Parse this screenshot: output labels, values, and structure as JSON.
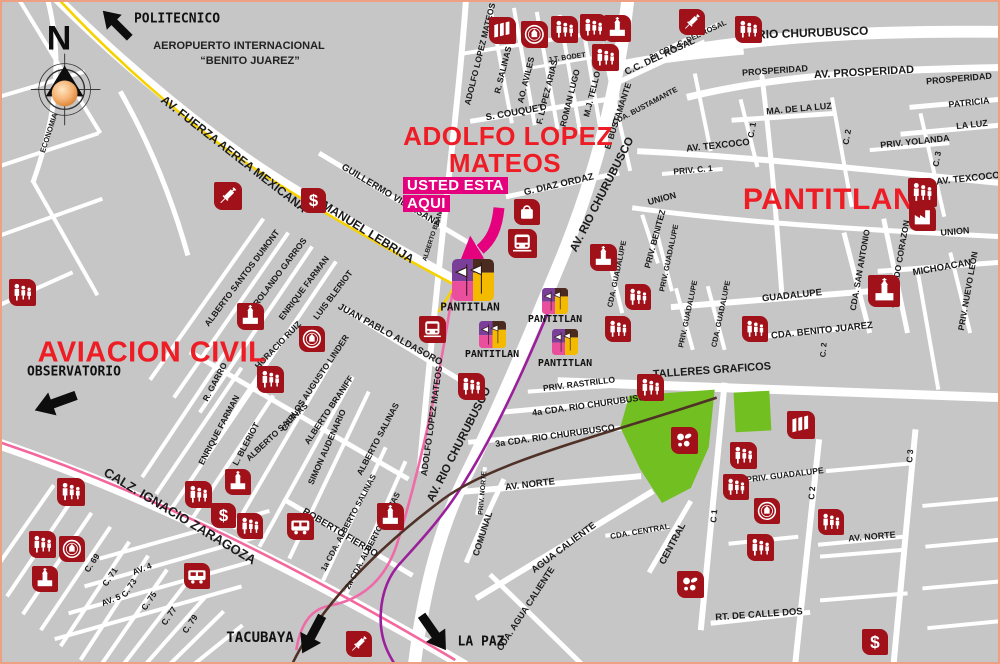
{
  "map": {
    "land_color": "#c6c6c6",
    "street_color": "#ffffff",
    "frame_color": "#eda182",
    "poi_color": "#a0111a",
    "title_color": "#ee1c25",
    "park_color": "#72bf22",
    "lines": {
      "yellow": "#f6d200",
      "pink": "#f4679d",
      "station_pink": "#f06aa8",
      "purple": "#9b1f9b",
      "brown": "#4f3127"
    },
    "highlight_color": "#e5007d"
  },
  "compass": {
    "letter": "N"
  },
  "airport": {
    "line1": "AEROPUERTO INTERNACIONAL",
    "line2": "“BENITO JUAREZ”"
  },
  "you_are_here": {
    "line1": "USTED ESTA",
    "line2": "AQUI"
  },
  "titles": [
    {
      "t": "ADOLFO LOPEZ",
      "x": 506,
      "y": 134,
      "s": 26
    },
    {
      "t": "MATEOS",
      "x": 503,
      "y": 161,
      "s": 26
    },
    {
      "t": "PANTITLAN",
      "x": 827,
      "y": 198,
      "s": 30
    },
    {
      "t": "AVIACION CIVIL",
      "x": 150,
      "y": 351,
      "s": 29
    }
  ],
  "destinations": [
    {
      "label": "POLITECNICO",
      "lx": 175,
      "ly": 17,
      "ls": 13,
      "ax": 114,
      "ay": 22,
      "aw": 40,
      "rot": -135
    },
    {
      "label": "OBSERVATORIO",
      "lx": 72,
      "ly": 370,
      "ls": 13,
      "ax": 53,
      "ay": 401,
      "aw": 46,
      "rot": 160
    },
    {
      "label": "TACUBAYA",
      "lx": 258,
      "ly": 636,
      "ls": 14,
      "ax": 310,
      "ay": 633,
      "aw": 44,
      "rot": 118
    },
    {
      "label": "LA PAZ",
      "lx": 479,
      "ly": 640,
      "ls": 13,
      "ax": 432,
      "ay": 631,
      "aw": 44,
      "rot": 55
    }
  ],
  "stations": [
    {
      "label": "PANTITLAN",
      "ix": 450,
      "iy": 257,
      "iw": 42,
      "lx": 468,
      "ly": 305,
      "ls": 11
    },
    {
      "label": "PANTITLAN",
      "ix": 540,
      "iy": 286,
      "iw": 26,
      "lx": 553,
      "ly": 318,
      "ls": 10
    },
    {
      "label": "PANTITLAN",
      "ix": 477,
      "iy": 319,
      "iw": 27,
      "lx": 490,
      "ly": 353,
      "ls": 10
    },
    {
      "label": "PANTITLAN",
      "ix": 550,
      "iy": 327,
      "iw": 26,
      "lx": 563,
      "ly": 362,
      "ls": 10
    }
  ],
  "street_labels": [
    {
      "t": "AV. FUERZA AEREA MEXICANA",
      "x": 232,
      "y": 152,
      "r": 38,
      "s": 12
    },
    {
      "t": "MANUEL LEBRIJA",
      "x": 366,
      "y": 230,
      "r": 32,
      "s": 12
    },
    {
      "t": "CALZ. IGNACIO ZARAGOZA",
      "x": 178,
      "y": 514,
      "r": 31,
      "s": 13
    },
    {
      "t": "AV. RIO CHURUBUSCO",
      "x": 800,
      "y": 31,
      "r": -2,
      "s": 12
    },
    {
      "t": "AV. RIO CHURUBUSCO",
      "x": 601,
      "y": 193,
      "r": -63,
      "s": 11.5
    },
    {
      "t": "AV. RIO CHURUBUSCO",
      "x": 458,
      "y": 443,
      "r": -63,
      "s": 11.5
    },
    {
      "t": "AV. PROSPERIDAD",
      "x": 862,
      "y": 71,
      "r": -3,
      "s": 11
    },
    {
      "t": "PROSPERIDAD",
      "x": 773,
      "y": 69,
      "r": -4,
      "s": 9
    },
    {
      "t": "PROSPERIDAD",
      "x": 957,
      "y": 77,
      "r": -5,
      "s": 9
    },
    {
      "t": "TALLERES GRAFICOS",
      "x": 710,
      "y": 369,
      "r": -4,
      "s": 11
    },
    {
      "t": "ADOLFO LOPEZ MATEOS",
      "x": 478,
      "y": 52,
      "r": -76,
      "s": 8.5
    },
    {
      "t": "R. SALINAS",
      "x": 501,
      "y": 68,
      "r": -76,
      "s": 8.5
    },
    {
      "t": "AO. AVILES",
      "x": 524,
      "y": 78,
      "r": -76,
      "s": 8.5
    },
    {
      "t": "F. LOPEZ ARIAS",
      "x": 545,
      "y": 90,
      "r": -76,
      "s": 8.5
    },
    {
      "t": "ROMAN LUGO",
      "x": 568,
      "y": 96,
      "r": -76,
      "s": 8.5
    },
    {
      "t": "M.J. TELLO",
      "x": 590,
      "y": 92,
      "r": -76,
      "s": 8.5
    },
    {
      "t": "E. BUSTAMANTE",
      "x": 616,
      "y": 114,
      "r": -72,
      "s": 8.5
    },
    {
      "t": "CDA. BUSTAMANTE",
      "x": 643,
      "y": 104,
      "r": -28,
      "s": 7.5
    },
    {
      "t": "J.T. BODET",
      "x": 565,
      "y": 56,
      "r": -8,
      "s": 7
    },
    {
      "t": "S. COUQUET",
      "x": 513,
      "y": 111,
      "r": -10,
      "s": 9.5
    },
    {
      "t": "G. DIAZ ORDAZ",
      "x": 557,
      "y": 183,
      "r": -13,
      "s": 9.5
    },
    {
      "t": "C.C. DEL ROSAL",
      "x": 658,
      "y": 55,
      "r": -25,
      "s": 9.5
    },
    {
      "t": "2a CDA. C. DEL ROSAL",
      "x": 686,
      "y": 38,
      "r": -25,
      "s": 7.5
    },
    {
      "t": "GUILLERMO VILLASANA",
      "x": 389,
      "y": 194,
      "r": 31,
      "s": 9.5
    },
    {
      "t": "ALBERTO BRANIFF",
      "x": 433,
      "y": 230,
      "r": -72,
      "s": 6.5
    },
    {
      "t": "MA. DE LA LUZ",
      "x": 797,
      "y": 107,
      "r": -5,
      "s": 9
    },
    {
      "t": "PATRICIA",
      "x": 967,
      "y": 101,
      "r": -6,
      "s": 9
    },
    {
      "t": "LA LUZ",
      "x": 970,
      "y": 123,
      "r": -6,
      "s": 9
    },
    {
      "t": "PRIV. YOLANDA",
      "x": 913,
      "y": 140,
      "r": -6,
      "s": 9
    },
    {
      "t": "AV. TEXCOCO",
      "x": 716,
      "y": 144,
      "r": -6,
      "s": 9.5
    },
    {
      "t": "AV. TEXCOCO",
      "x": 966,
      "y": 177,
      "r": -6,
      "s": 9.5
    },
    {
      "t": "PRIV. C. 1",
      "x": 691,
      "y": 168,
      "r": -5,
      "s": 8.5
    },
    {
      "t": "UNION",
      "x": 660,
      "y": 197,
      "r": -15,
      "s": 9
    },
    {
      "t": "UNION",
      "x": 953,
      "y": 230,
      "r": -5,
      "s": 9
    },
    {
      "t": "C. 1",
      "x": 750,
      "y": 128,
      "r": -80,
      "s": 8.5
    },
    {
      "t": "C. 2",
      "x": 845,
      "y": 135,
      "r": -80,
      "s": 8.5
    },
    {
      "t": "C. 3",
      "x": 935,
      "y": 157,
      "r": -80,
      "s": 8.5
    },
    {
      "t": "MICHOACAN",
      "x": 940,
      "y": 266,
      "r": -10,
      "s": 9.5
    },
    {
      "t": "PRIV. NUEVO LEON",
      "x": 966,
      "y": 289,
      "r": -80,
      "s": 8.5
    },
    {
      "t": "SAGRADO CORAZON",
      "x": 897,
      "y": 262,
      "r": -80,
      "s": 8.5
    },
    {
      "t": "CDA. SAN ANTONIO",
      "x": 858,
      "y": 268,
      "r": -80,
      "s": 8.5
    },
    {
      "t": "GUADALUPE",
      "x": 790,
      "y": 294,
      "r": -6,
      "s": 9.5
    },
    {
      "t": "CDA. BENITO JUAREZ",
      "x": 820,
      "y": 329,
      "r": -6,
      "s": 9.5
    },
    {
      "t": "C. 2",
      "x": 822,
      "y": 348,
      "r": -85,
      "s": 8
    },
    {
      "t": "PRIV. BENITEZ",
      "x": 653,
      "y": 237,
      "r": -75,
      "s": 8.5
    },
    {
      "t": "CDA. GUADALUPE",
      "x": 615,
      "y": 272,
      "r": -78,
      "s": 7.5
    },
    {
      "t": "PRIV. GUADALUPE",
      "x": 667,
      "y": 256,
      "r": -78,
      "s": 7.5
    },
    {
      "t": "PRIV. GUADALUPE",
      "x": 686,
      "y": 312,
      "r": -78,
      "s": 7.5
    },
    {
      "t": "CDA. GUADALUPE",
      "x": 719,
      "y": 312,
      "r": -78,
      "s": 7.5
    },
    {
      "t": "PRIV. RASTRILLO",
      "x": 577,
      "y": 382,
      "r": -7,
      "s": 8.5
    },
    {
      "t": "4a CDA. RIO CHURUBUSCO",
      "x": 590,
      "y": 403,
      "r": -8,
      "s": 9
    },
    {
      "t": "3a CDA. RIO CHURUBUSCO",
      "x": 553,
      "y": 434,
      "r": -8,
      "s": 9
    },
    {
      "t": "PRIV. GUADALUPE",
      "x": 783,
      "y": 473,
      "r": -7,
      "s": 8.5
    },
    {
      "t": "C 1",
      "x": 712,
      "y": 514,
      "r": -85,
      "s": 8.5
    },
    {
      "t": "C 2",
      "x": 810,
      "y": 491,
      "r": -85,
      "s": 8.5
    },
    {
      "t": "C 3",
      "x": 908,
      "y": 454,
      "r": -85,
      "s": 8.5
    },
    {
      "t": "AV. NORTE",
      "x": 870,
      "y": 535,
      "r": -5,
      "s": 9
    },
    {
      "t": "RT. DE CALLE DOS",
      "x": 757,
      "y": 613,
      "r": -4,
      "s": 9.5
    },
    {
      "t": "AV. NORTE",
      "x": 528,
      "y": 483,
      "r": -7,
      "s": 9.5
    },
    {
      "t": "PRIV. NORTE",
      "x": 481,
      "y": 491,
      "r": -85,
      "s": 7
    },
    {
      "t": "COMUNAL",
      "x": 481,
      "y": 532,
      "r": -72,
      "s": 9
    },
    {
      "t": "AGUA CALIENTE",
      "x": 562,
      "y": 546,
      "r": -37,
      "s": 9.5
    },
    {
      "t": "CDA. AGUA CALIENTE",
      "x": 524,
      "y": 607,
      "r": -57,
      "s": 9
    },
    {
      "t": "CDA. CENTRAL",
      "x": 638,
      "y": 530,
      "r": -10,
      "s": 8
    },
    {
      "t": "CENTRAL",
      "x": 671,
      "y": 542,
      "r": -62,
      "s": 9.5
    },
    {
      "t": "ALBERTO SANTOS DUMONT",
      "x": 240,
      "y": 276,
      "r": -53,
      "s": 8.5
    },
    {
      "t": "ROLANDO GARROS",
      "x": 278,
      "y": 270,
      "r": -53,
      "s": 8.5
    },
    {
      "t": "ENRIQUE FARMAN",
      "x": 302,
      "y": 286,
      "r": -53,
      "s": 8.5
    },
    {
      "t": "LUIS BLERIOT",
      "x": 331,
      "y": 293,
      "r": -53,
      "s": 8.5
    },
    {
      "t": "JUAN PABLO ALDASORO",
      "x": 388,
      "y": 333,
      "r": 29,
      "s": 9.5
    },
    {
      "t": "HORACIO RUIZ",
      "x": 276,
      "y": 343,
      "r": -46,
      "s": 8.5
    },
    {
      "t": "CARLOS AUGUSTO LINDER",
      "x": 313,
      "y": 381,
      "r": -56,
      "s": 8.5
    },
    {
      "t": "ALBERTO BRANIFF",
      "x": 327,
      "y": 408,
      "r": -56,
      "s": 8.5
    },
    {
      "t": "R. GARRO",
      "x": 213,
      "y": 380,
      "r": -62,
      "s": 8.5
    },
    {
      "t": "ENRIQUE FARMAN",
      "x": 217,
      "y": 428,
      "r": -62,
      "s": 8.5
    },
    {
      "t": "ALBERTO SALINAS",
      "x": 275,
      "y": 430,
      "r": -43,
      "s": 8.5
    },
    {
      "t": "L. BLERIOT",
      "x": 244,
      "y": 442,
      "r": -62,
      "s": 8.5
    },
    {
      "t": "SIMON AUDENARIO",
      "x": 325,
      "y": 445,
      "r": -66,
      "s": 8.5
    },
    {
      "t": "ALBERTO SALINAS",
      "x": 376,
      "y": 437,
      "r": -62,
      "s": 8.5
    },
    {
      "t": "1a CDA. ALBERTO SALINAS",
      "x": 347,
      "y": 521,
      "r": -62,
      "s": 8
    },
    {
      "t": "2a CDA. ALBERTO SALINAS",
      "x": 371,
      "y": 539,
      "r": -62,
      "s": 8
    },
    {
      "t": "ROBERTO FIERRO",
      "x": 338,
      "y": 531,
      "r": 31,
      "s": 9.5
    },
    {
      "t": "ADOLFO LOPEZ MATEOS",
      "x": 430,
      "y": 419,
      "r": -82,
      "s": 9
    },
    {
      "t": "ECONOMIA",
      "x": 47,
      "y": 131,
      "r": -72,
      "s": 7.5
    },
    {
      "t": "C. 69",
      "x": 90,
      "y": 561,
      "r": -56,
      "s": 8.5
    },
    {
      "t": "C. 71",
      "x": 108,
      "y": 575,
      "r": -56,
      "s": 8.5
    },
    {
      "t": "C. 73",
      "x": 127,
      "y": 586,
      "r": -56,
      "s": 8.5
    },
    {
      "t": "C. 75",
      "x": 147,
      "y": 599,
      "r": -56,
      "s": 8.5
    },
    {
      "t": "C. 77",
      "x": 167,
      "y": 614,
      "r": -56,
      "s": 8.5
    },
    {
      "t": "C. 79",
      "x": 188,
      "y": 622,
      "r": -56,
      "s": 8.5
    },
    {
      "t": "AV. 4",
      "x": 140,
      "y": 567,
      "r": -22,
      "s": 8.5
    },
    {
      "t": "AV. 5",
      "x": 109,
      "y": 598,
      "r": -22,
      "s": 8.5
    }
  ],
  "pois": [
    {
      "k": "people",
      "x": 7,
      "y": 277,
      "w": 27
    },
    {
      "k": "people",
      "x": 549,
      "y": 14,
      "w": 27
    },
    {
      "k": "people",
      "x": 578,
      "y": 12,
      "w": 27
    },
    {
      "k": "people",
      "x": 590,
      "y": 42,
      "w": 27
    },
    {
      "k": "people",
      "x": 733,
      "y": 14,
      "w": 27
    },
    {
      "k": "people",
      "x": 906,
      "y": 176,
      "w": 29
    },
    {
      "k": "people",
      "x": 255,
      "y": 364,
      "w": 27
    },
    {
      "k": "people",
      "x": 456,
      "y": 371,
      "w": 27
    },
    {
      "k": "people",
      "x": 635,
      "y": 372,
      "w": 27
    },
    {
      "k": "people",
      "x": 623,
      "y": 282,
      "w": 26
    },
    {
      "k": "people",
      "x": 603,
      "y": 314,
      "w": 26
    },
    {
      "k": "people",
      "x": 740,
      "y": 314,
      "w": 26
    },
    {
      "k": "people",
      "x": 55,
      "y": 476,
      "w": 28
    },
    {
      "k": "people",
      "x": 27,
      "y": 529,
      "w": 27
    },
    {
      "k": "people",
      "x": 183,
      "y": 479,
      "w": 27
    },
    {
      "k": "people",
      "x": 235,
      "y": 511,
      "w": 26
    },
    {
      "k": "people",
      "x": 728,
      "y": 440,
      "w": 27
    },
    {
      "k": "people",
      "x": 721,
      "y": 472,
      "w": 26
    },
    {
      "k": "people",
      "x": 745,
      "y": 532,
      "w": 27
    },
    {
      "k": "people",
      "x": 816,
      "y": 507,
      "w": 26
    },
    {
      "k": "church",
      "x": 602,
      "y": 13,
      "w": 27
    },
    {
      "k": "church",
      "x": 235,
      "y": 301,
      "w": 27
    },
    {
      "k": "church",
      "x": 223,
      "y": 467,
      "w": 26
    },
    {
      "k": "church",
      "x": 375,
      "y": 501,
      "w": 27
    },
    {
      "k": "church",
      "x": 30,
      "y": 564,
      "w": 26
    },
    {
      "k": "church",
      "x": 588,
      "y": 242,
      "w": 27
    },
    {
      "k": "church",
      "x": 866,
      "y": 273,
      "w": 32
    },
    {
      "k": "book",
      "x": 487,
      "y": 15,
      "w": 27
    },
    {
      "k": "book",
      "x": 785,
      "y": 409,
      "w": 28
    },
    {
      "k": "seal",
      "x": 519,
      "y": 19,
      "w": 27
    },
    {
      "k": "seal",
      "x": 297,
      "y": 324,
      "w": 26
    },
    {
      "k": "seal",
      "x": 57,
      "y": 534,
      "w": 26
    },
    {
      "k": "seal",
      "x": 752,
      "y": 496,
      "w": 26
    },
    {
      "k": "dollar",
      "x": 299,
      "y": 186,
      "w": 25
    },
    {
      "k": "dollar",
      "x": 209,
      "y": 501,
      "w": 25
    },
    {
      "k": "dollar",
      "x": 860,
      "y": 627,
      "w": 26
    },
    {
      "k": "syringe",
      "x": 212,
      "y": 180,
      "w": 28
    },
    {
      "k": "syringe",
      "x": 677,
      "y": 7,
      "w": 26
    },
    {
      "k": "syringe",
      "x": 344,
      "y": 629,
      "w": 26
    },
    {
      "k": "bus",
      "x": 285,
      "y": 511,
      "w": 27
    },
    {
      "k": "bus",
      "x": 182,
      "y": 561,
      "w": 26
    },
    {
      "k": "metrofront",
      "x": 506,
      "y": 227,
      "w": 29
    },
    {
      "k": "metrofront",
      "x": 417,
      "y": 314,
      "w": 27
    },
    {
      "k": "bag",
      "x": 512,
      "y": 197,
      "w": 26
    },
    {
      "k": "factory",
      "x": 907,
      "y": 202,
      "w": 27
    },
    {
      "k": "sports",
      "x": 669,
      "y": 425,
      "w": 27
    },
    {
      "k": "sports",
      "x": 675,
      "y": 569,
      "w": 27
    }
  ]
}
